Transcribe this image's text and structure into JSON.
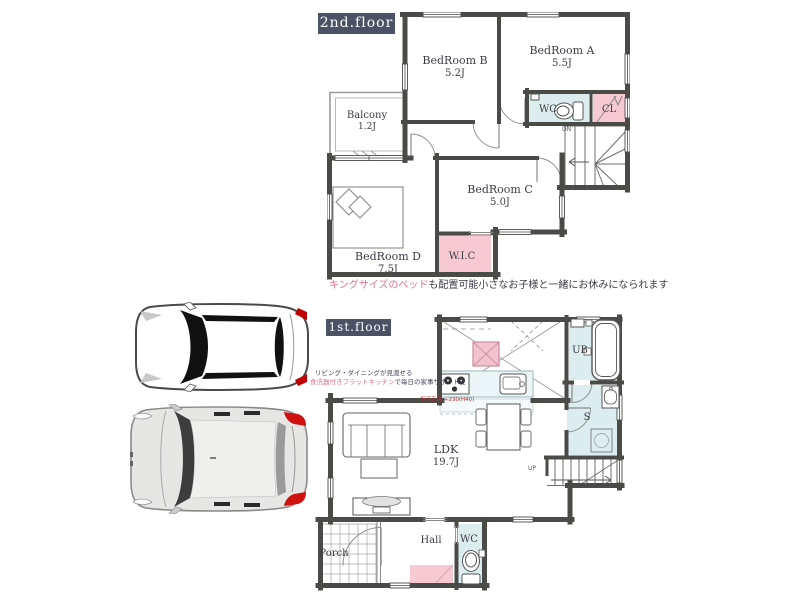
{
  "floor2": {
    "label": "2nd.floor",
    "rooms": {
      "bedroom_b": {
        "name": "BedRoom B",
        "size": "5.2J"
      },
      "bedroom_a": {
        "name": "BedRoom A",
        "size": "5.5J"
      },
      "balcony": {
        "name": "Balcony",
        "size": "1.2J"
      },
      "bedroom_c": {
        "name": "BedRoom C",
        "size": "5.0J"
      },
      "bedroom_d": {
        "name": "BedRoom D",
        "size": "7.5J"
      },
      "wc": "WC",
      "cl": "CL",
      "wic": "W.I.C",
      "stair_dir": "DN"
    },
    "caption": {
      "highlight": "キングサイズのベッド",
      "rest": "も配置可能小さなお子様と一緒にお休みになられます"
    }
  },
  "floor1": {
    "label": "1st.floor",
    "rooms": {
      "ldk": {
        "name": "LDK",
        "size": "19.7J"
      },
      "ub": "UB",
      "storage": "S",
      "hall": "Hall",
      "wc": "WC",
      "porch": "Porch",
      "stair_dir": "UP"
    },
    "notes": {
      "line1": "リビング・ダイニングが見渡せる",
      "line2_highlight": "食洗器付きフラットキッチン",
      "line2_rest": "で毎日の家事サポートに",
      "ceiling": "折下天井 +230(H40)"
    }
  },
  "colors": {
    "wall": "#4a4a47",
    "room_blue": "#dcedf0",
    "room_pink": "#f7c9d3",
    "label_bg": "#4c5266",
    "highlight_pink": "#e0718f",
    "text_dark": "#3b3b46",
    "note_red": "#c03030"
  }
}
